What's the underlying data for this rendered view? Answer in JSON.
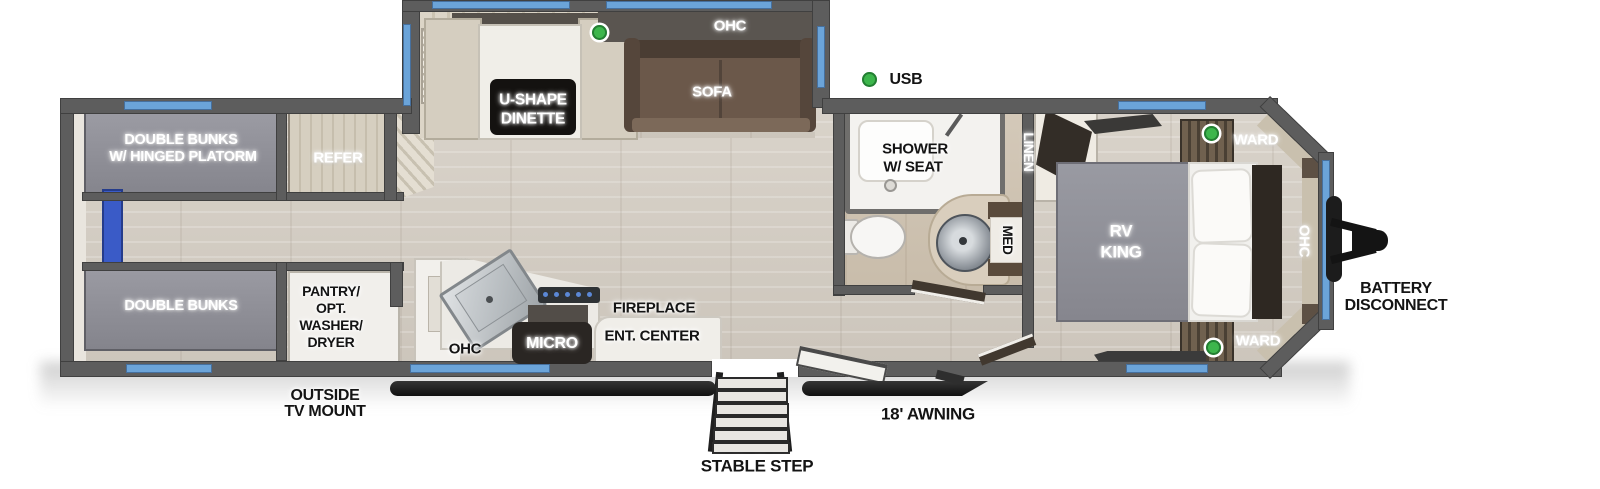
{
  "title": "Travel trailer floor plan",
  "palette": {
    "wall": "#5d5d5d",
    "window": "#6ba4d9",
    "led": "#3db64c",
    "ladder-blue": "#3a5bc7",
    "floor-wood": "#d3ccc2",
    "bunk-gray": "#8c8c94",
    "sofa-brown": "#6b584a",
    "label-black-box": "#141210"
  },
  "labels": {
    "ohc_top": "OHC",
    "sofa": "SOFA",
    "usb": "USB",
    "dinette_l1": "U-SHAPE",
    "dinette_l2": "DINETTE",
    "bunks_top_l1": "DOUBLE BUNKS",
    "bunks_top_l2": "W/ HINGED PLATORM",
    "refer": "REFER",
    "bunks_bottom": "DOUBLE BUNKS",
    "pantry_l1": "PANTRY/",
    "pantry_l2": "OPT.",
    "pantry_l3": "WASHER/",
    "pantry_l4": "DRYER",
    "outside_tv_l1": "OUTSIDE",
    "outside_tv_l2": "TV MOUNT",
    "ohc_kitchen": "OHC",
    "micro": "MICRO",
    "fireplace": "FIREPLACE",
    "ent_center": "ENT. CENTER",
    "stable_step": "STABLE STEP",
    "awning": "18' AWNING",
    "shower_l1": "SHOWER",
    "shower_l2": "W/ SEAT",
    "med": "MED",
    "linen": "LINEN",
    "ward_top": "WARD",
    "ward_bottom": "WARD",
    "rv_king_l1": "RV",
    "rv_king_l2": "KING",
    "ohc_bedroom": "OHC",
    "battery_l1": "BATTERY",
    "battery_l2": "DISCONNECT"
  }
}
